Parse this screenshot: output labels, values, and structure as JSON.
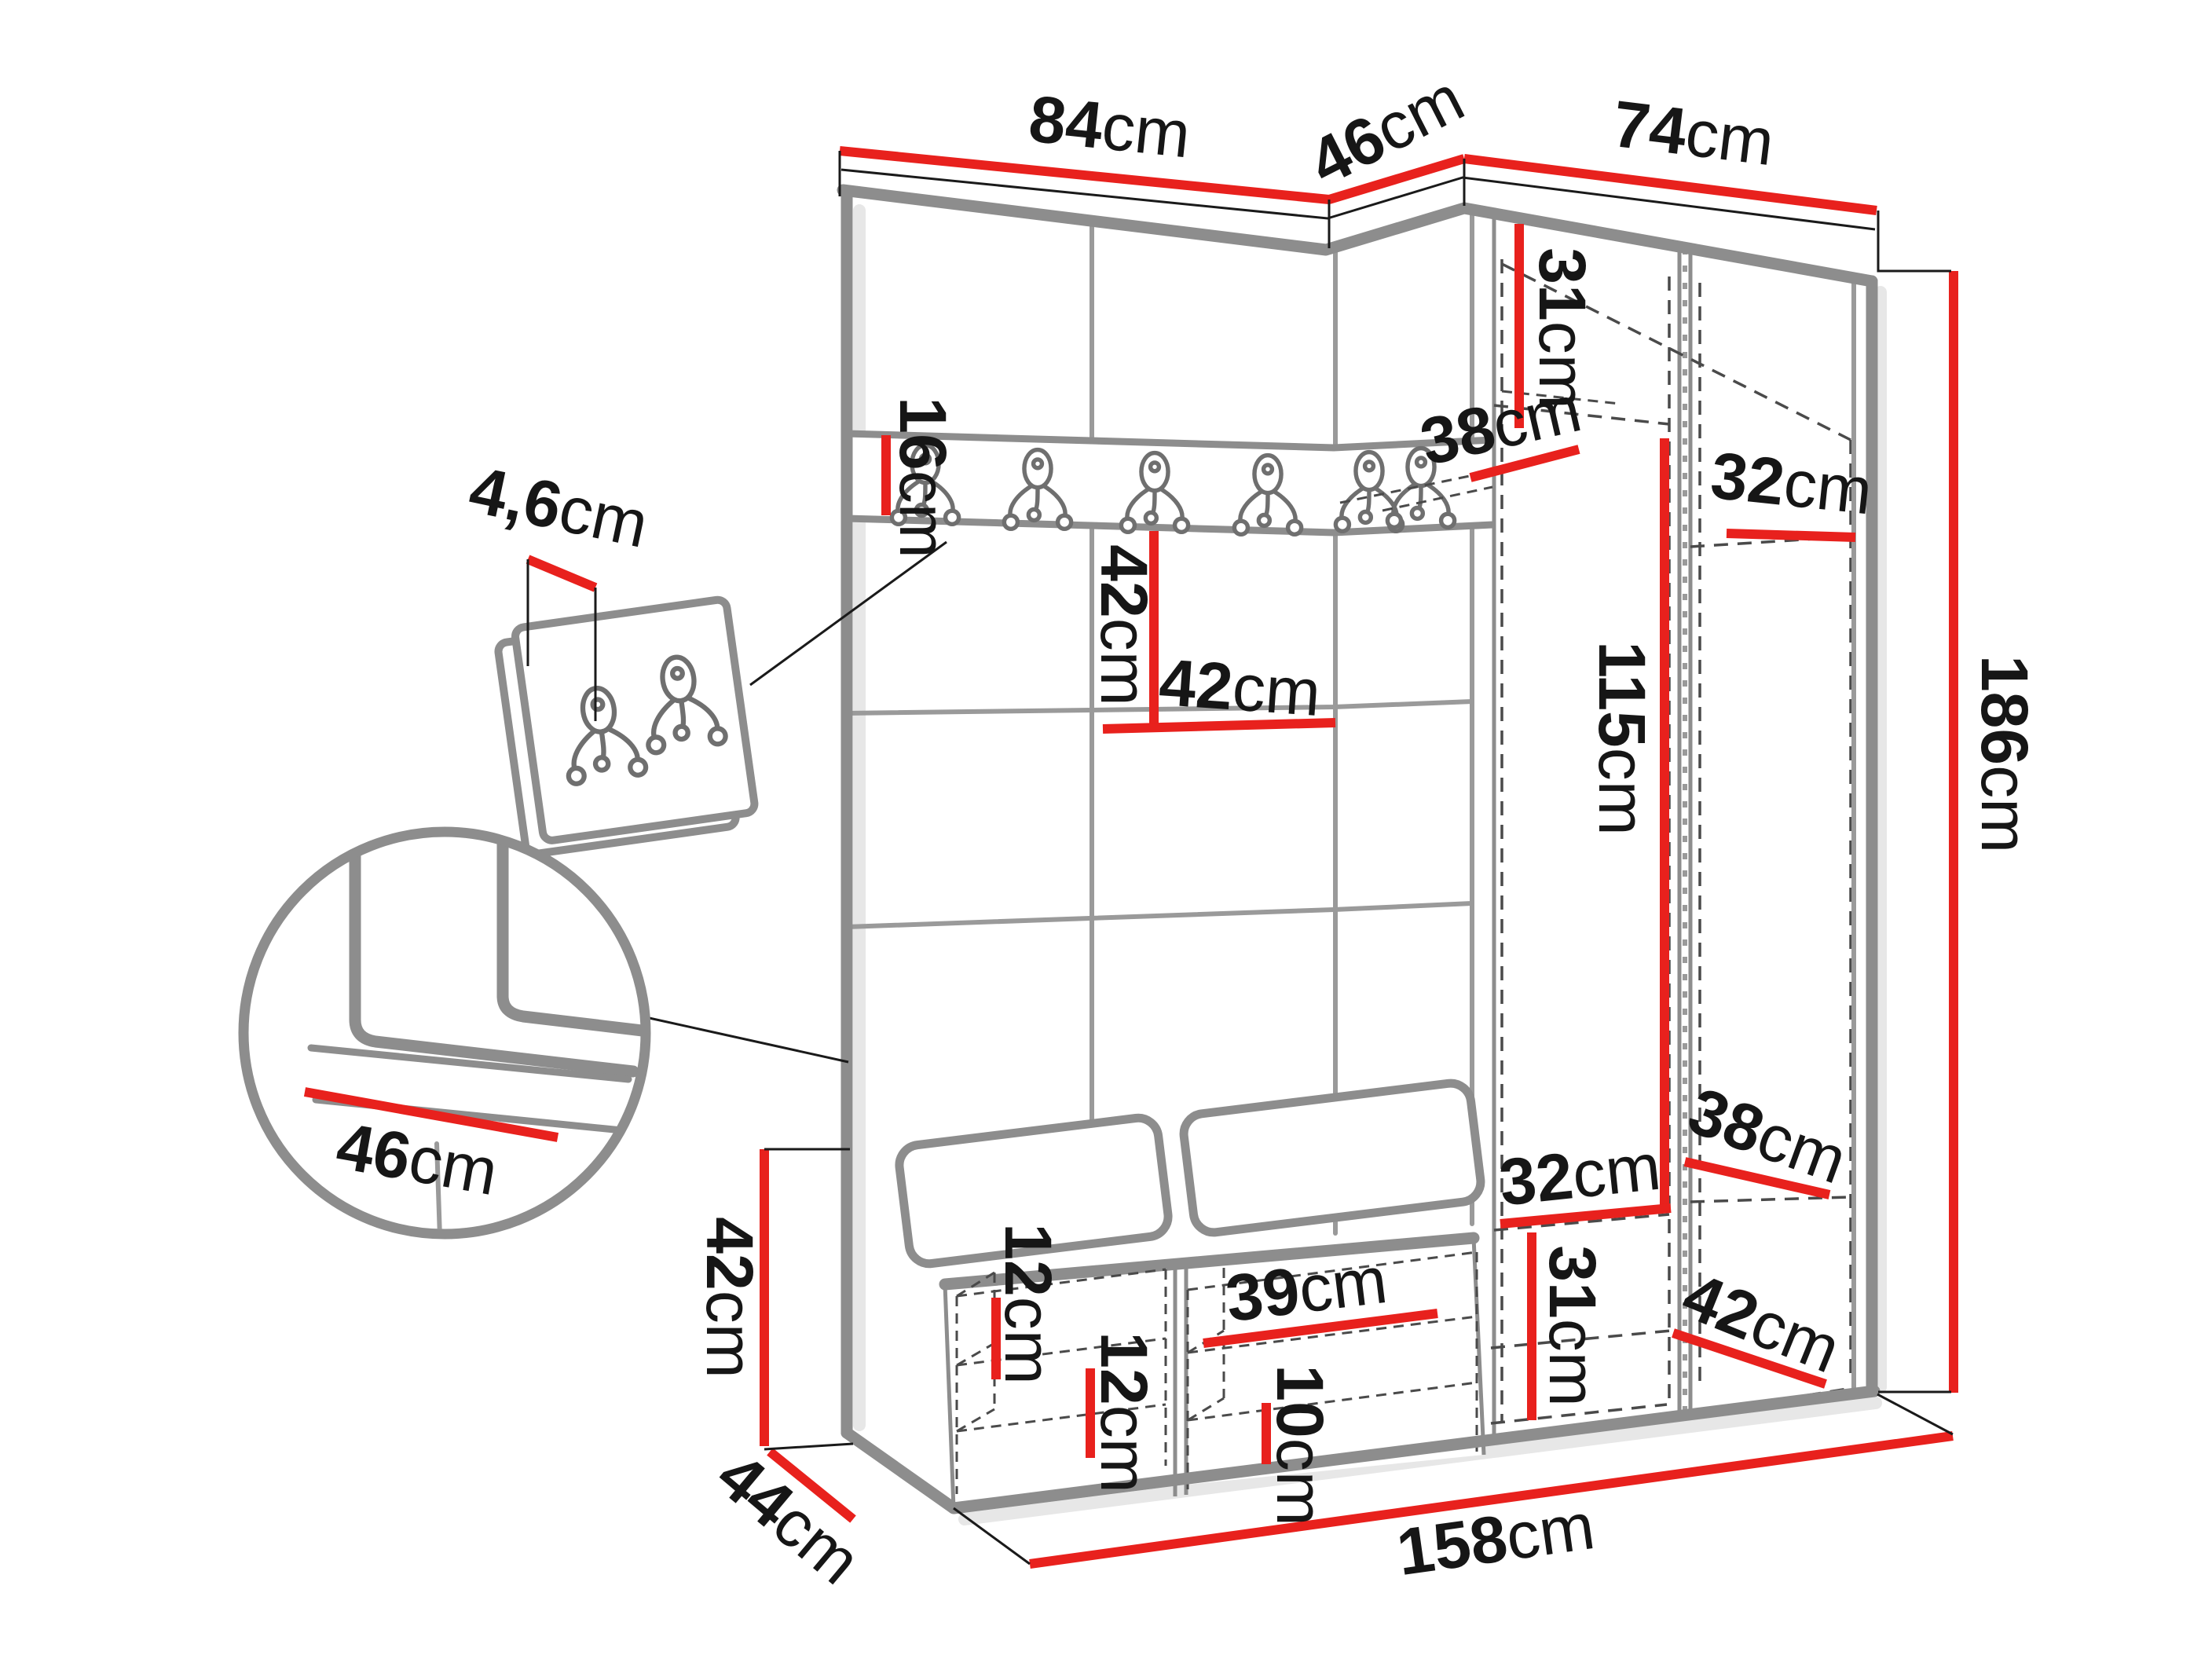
{
  "diagram_type": "furniture-dimension-drawing",
  "subject": "corner hallway wardrobe set with panel wall, coat hooks and shoe bench",
  "unit": "cm",
  "colors": {
    "dimension_line": "#e8211d",
    "outline_gray": "#8d8d8d",
    "text": "#161616",
    "dashed": "#4a4a4a"
  },
  "icons": {
    "coat_hook": "double-coat-hook-icon",
    "rail_hook_count": 6,
    "panel_hook_count": 2
  },
  "dims": {
    "w84": {
      "num": "84",
      "unit": "cm"
    },
    "w46": {
      "num": "46",
      "unit": "cm"
    },
    "w74": {
      "num": "74",
      "unit": "cm"
    },
    "h186": {
      "num": "186",
      "unit": "cm"
    },
    "h31top": {
      "num": "31",
      "unit": "cm"
    },
    "d38top": {
      "num": "38",
      "unit": "cm"
    },
    "w32top": {
      "num": "32",
      "unit": "cm"
    },
    "h16": {
      "num": "16",
      "unit": "cm"
    },
    "h42mid": {
      "num": "42",
      "unit": "cm"
    },
    "w42mid": {
      "num": "42",
      "unit": "cm"
    },
    "h115": {
      "num": "115",
      "unit": "cm"
    },
    "w32bot": {
      "num": "32",
      "unit": "cm"
    },
    "h31bot": {
      "num": "31",
      "unit": "cm"
    },
    "d38bot": {
      "num": "38",
      "unit": "cm"
    },
    "d42bot": {
      "num": "42",
      "unit": "cm"
    },
    "h12a": {
      "num": "12",
      "unit": "cm"
    },
    "h12b": {
      "num": "12",
      "unit": "cm"
    },
    "w39": {
      "num": "39",
      "unit": "cm"
    },
    "h10": {
      "num": "10",
      "unit": "cm"
    },
    "h42bench": {
      "num": "42",
      "unit": "cm"
    },
    "d44": {
      "num": "44",
      "unit": "cm"
    },
    "w158": {
      "num": "158",
      "unit": "cm"
    },
    "w46seat": {
      "num": "46",
      "unit": "cm"
    },
    "t46panel": {
      "num": "4,6",
      "unit": "cm"
    }
  }
}
